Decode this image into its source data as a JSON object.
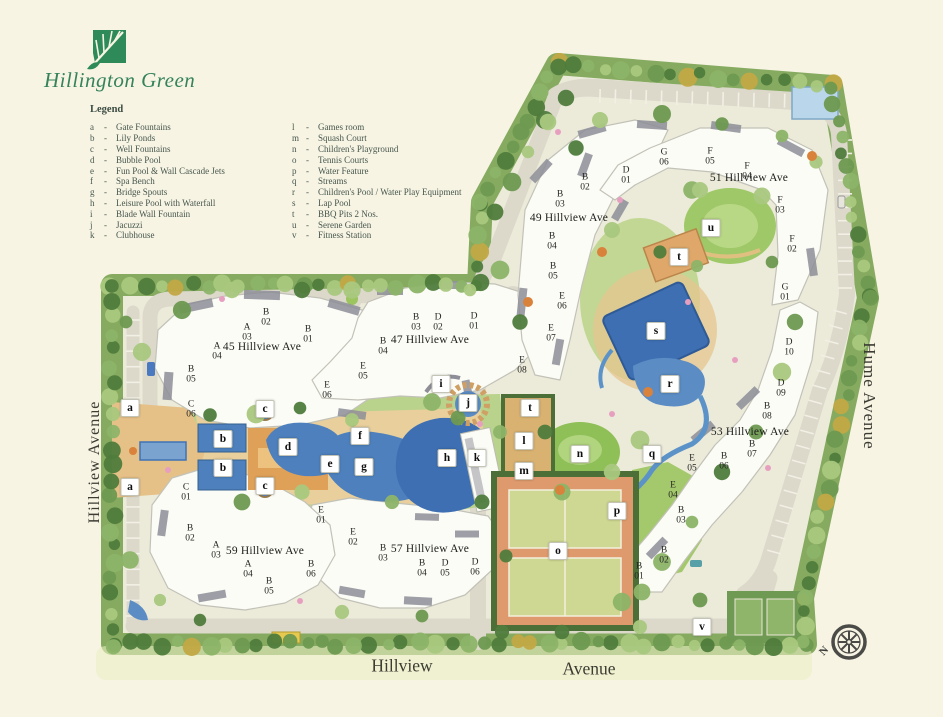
{
  "brand": {
    "name": "Hillington Green",
    "title_color": "#35835b"
  },
  "legend": {
    "heading": "Legend",
    "dash": "-",
    "left": [
      {
        "key": "a",
        "label": "Gate Fountains"
      },
      {
        "key": "b",
        "label": "Lily Ponds"
      },
      {
        "key": "c",
        "label": "Well Fountains"
      },
      {
        "key": "d",
        "label": "Bubble Pool"
      },
      {
        "key": "e",
        "label": "Fun Pool & Wall Cascade Jets"
      },
      {
        "key": "f",
        "label": "Spa Bench"
      },
      {
        "key": "g",
        "label": "Bridge Spouts"
      },
      {
        "key": "h",
        "label": "Leisure Pool with Waterfall"
      },
      {
        "key": "i",
        "label": "Blade Wall Fountain"
      },
      {
        "key": "j",
        "label": "Jacuzzi"
      },
      {
        "key": "k",
        "label": "Clubhouse"
      }
    ],
    "right": [
      {
        "key": "l",
        "label": "Games room"
      },
      {
        "key": "m",
        "label": "Squash Court"
      },
      {
        "key": "n",
        "label": "Children's Playground"
      },
      {
        "key": "o",
        "label": "Tennis Courts"
      },
      {
        "key": "p",
        "label": "Water Feature"
      },
      {
        "key": "q",
        "label": "Streams"
      },
      {
        "key": "r",
        "label": "Children's Pool / Water Play Equipment"
      },
      {
        "key": "s",
        "label": "Lap Pool"
      },
      {
        "key": "t",
        "label": "BBQ Pits 2 Nos."
      },
      {
        "key": "u",
        "label": "Serene Garden"
      },
      {
        "key": "v",
        "label": "Fitness Station"
      }
    ]
  },
  "streets": {
    "left": "Hillview Avenue",
    "right": "Hume Avenue",
    "bottom_left": "Hillview",
    "bottom_right": "Avenue"
  },
  "compass": {
    "label": "N"
  },
  "map": {
    "addresses": [
      {
        "text": "45 Hillview Ave",
        "x": 262,
        "y": 347
      },
      {
        "text": "47 Hillview Ave",
        "x": 430,
        "y": 340
      },
      {
        "text": "49 Hillview Ave",
        "x": 569,
        "y": 218
      },
      {
        "text": "51 Hillview Ave",
        "x": 749,
        "y": 178
      },
      {
        "text": "53 Hillview Ave",
        "x": 750,
        "y": 432
      },
      {
        "text": "57 Hillview Ave",
        "x": 430,
        "y": 549
      },
      {
        "text": "59 Hillview Ave",
        "x": 265,
        "y": 551
      }
    ],
    "blocks": [
      {
        "addr": "45",
        "block": "B",
        "unit": "02",
        "x": 266,
        "y": 318
      },
      {
        "addr": "45",
        "block": "A",
        "unit": "03",
        "x": 247,
        "y": 333
      },
      {
        "addr": "45",
        "block": "A",
        "unit": "04",
        "x": 217,
        "y": 352
      },
      {
        "addr": "45",
        "block": "B",
        "unit": "01",
        "x": 308,
        "y": 335
      },
      {
        "addr": "45",
        "block": "B",
        "unit": "05",
        "x": 191,
        "y": 375
      },
      {
        "addr": "45",
        "block": "C",
        "unit": "06",
        "x": 191,
        "y": 410
      },
      {
        "addr": "47",
        "block": "B",
        "unit": "04",
        "x": 383,
        "y": 347
      },
      {
        "addr": "47",
        "block": "B",
        "unit": "03",
        "x": 416,
        "y": 323
      },
      {
        "addr": "47",
        "block": "D",
        "unit": "02",
        "x": 438,
        "y": 323
      },
      {
        "addr": "47",
        "block": "D",
        "unit": "01",
        "x": 474,
        "y": 322
      },
      {
        "addr": "47",
        "block": "E",
        "unit": "05",
        "x": 363,
        "y": 372
      },
      {
        "addr": "47",
        "block": "E",
        "unit": "06",
        "x": 327,
        "y": 391
      },
      {
        "addr": "49",
        "block": "B",
        "unit": "02",
        "x": 585,
        "y": 183
      },
      {
        "addr": "49",
        "block": "B",
        "unit": "03",
        "x": 560,
        "y": 200
      },
      {
        "addr": "49",
        "block": "B",
        "unit": "04",
        "x": 552,
        "y": 242
      },
      {
        "addr": "49",
        "block": "B",
        "unit": "05",
        "x": 553,
        "y": 272
      },
      {
        "addr": "49",
        "block": "E",
        "unit": "06",
        "x": 562,
        "y": 302
      },
      {
        "addr": "49",
        "block": "E",
        "unit": "07",
        "x": 551,
        "y": 334
      },
      {
        "addr": "49",
        "block": "E",
        "unit": "08",
        "x": 522,
        "y": 366
      },
      {
        "addr": "49",
        "block": "G",
        "unit": "06",
        "x": 664,
        "y": 158
      },
      {
        "addr": "49",
        "block": "D",
        "unit": "01",
        "x": 626,
        "y": 176
      },
      {
        "addr": "51",
        "block": "F",
        "unit": "05",
        "x": 710,
        "y": 157
      },
      {
        "addr": "51",
        "block": "F",
        "unit": "04",
        "x": 747,
        "y": 172
      },
      {
        "addr": "51",
        "block": "F",
        "unit": "03",
        "x": 780,
        "y": 206
      },
      {
        "addr": "51",
        "block": "F",
        "unit": "02",
        "x": 792,
        "y": 245
      },
      {
        "addr": "51",
        "block": "G",
        "unit": "01",
        "x": 785,
        "y": 293
      },
      {
        "addr": "53",
        "block": "D",
        "unit": "10",
        "x": 789,
        "y": 348
      },
      {
        "addr": "53",
        "block": "D",
        "unit": "09",
        "x": 781,
        "y": 389
      },
      {
        "addr": "53",
        "block": "B",
        "unit": "08",
        "x": 767,
        "y": 412
      },
      {
        "addr": "53",
        "block": "B",
        "unit": "07",
        "x": 752,
        "y": 450
      },
      {
        "addr": "53",
        "block": "B",
        "unit": "06",
        "x": 724,
        "y": 462
      },
      {
        "addr": "53",
        "block": "E",
        "unit": "05",
        "x": 692,
        "y": 464
      },
      {
        "addr": "53",
        "block": "E",
        "unit": "04",
        "x": 673,
        "y": 491
      },
      {
        "addr": "53",
        "block": "B",
        "unit": "03",
        "x": 681,
        "y": 516
      },
      {
        "addr": "53",
        "block": "B",
        "unit": "02",
        "x": 664,
        "y": 556
      },
      {
        "addr": "53",
        "block": "B",
        "unit": "01",
        "x": 639,
        "y": 572
      },
      {
        "addr": "57",
        "block": "E",
        "unit": "01",
        "x": 321,
        "y": 516
      },
      {
        "addr": "57",
        "block": "E",
        "unit": "02",
        "x": 353,
        "y": 538
      },
      {
        "addr": "57",
        "block": "B",
        "unit": "03",
        "x": 383,
        "y": 554
      },
      {
        "addr": "57",
        "block": "B",
        "unit": "04",
        "x": 422,
        "y": 569
      },
      {
        "addr": "57",
        "block": "D",
        "unit": "05",
        "x": 445,
        "y": 569
      },
      {
        "addr": "57",
        "block": "D",
        "unit": "06",
        "x": 475,
        "y": 568
      },
      {
        "addr": "59",
        "block": "C",
        "unit": "01",
        "x": 186,
        "y": 493
      },
      {
        "addr": "59",
        "block": "B",
        "unit": "02",
        "x": 190,
        "y": 534
      },
      {
        "addr": "59",
        "block": "A",
        "unit": "03",
        "x": 216,
        "y": 551
      },
      {
        "addr": "59",
        "block": "A",
        "unit": "04",
        "x": 248,
        "y": 570
      },
      {
        "addr": "59",
        "block": "B",
        "unit": "05",
        "x": 269,
        "y": 587
      },
      {
        "addr": "59",
        "block": "B",
        "unit": "06",
        "x": 311,
        "y": 570
      }
    ],
    "markers": [
      {
        "key": "a",
        "x": 130,
        "y": 408
      },
      {
        "key": "a",
        "x": 130,
        "y": 487
      },
      {
        "key": "b",
        "x": 223,
        "y": 439
      },
      {
        "key": "b",
        "x": 223,
        "y": 468
      },
      {
        "key": "c",
        "x": 265,
        "y": 409
      },
      {
        "key": "c",
        "x": 265,
        "y": 486
      },
      {
        "key": "d",
        "x": 288,
        "y": 447
      },
      {
        "key": "e",
        "x": 330,
        "y": 464
      },
      {
        "key": "f",
        "x": 360,
        "y": 436
      },
      {
        "key": "g",
        "x": 364,
        "y": 467
      },
      {
        "key": "h",
        "x": 447,
        "y": 458
      },
      {
        "key": "i",
        "x": 441,
        "y": 384
      },
      {
        "key": "j",
        "x": 468,
        "y": 403
      },
      {
        "key": "k",
        "x": 477,
        "y": 458
      },
      {
        "key": "l",
        "x": 524,
        "y": 441
      },
      {
        "key": "m",
        "x": 524,
        "y": 471
      },
      {
        "key": "n",
        "x": 580,
        "y": 454
      },
      {
        "key": "o",
        "x": 558,
        "y": 551
      },
      {
        "key": "p",
        "x": 617,
        "y": 511
      },
      {
        "key": "q",
        "x": 652,
        "y": 454
      },
      {
        "key": "r",
        "x": 670,
        "y": 384
      },
      {
        "key": "s",
        "x": 656,
        "y": 331
      },
      {
        "key": "t",
        "x": 679,
        "y": 257
      },
      {
        "key": "t",
        "x": 530,
        "y": 408
      },
      {
        "key": "u",
        "x": 711,
        "y": 228
      },
      {
        "key": "v",
        "x": 702,
        "y": 627
      }
    ]
  },
  "colors": {
    "paper": "#f7f4e4",
    "site_base": "#ecebda",
    "road": "#dcd9cb",
    "tree_greens": [
      "#6d9950",
      "#4f7c3c",
      "#8cb468",
      "#a9c87e"
    ],
    "water": "#4d80bd",
    "water_dark": "#3e6fb2",
    "lawn": "#9cc45f",
    "deck_tan": "#e9cf9b",
    "plaza_orange": "#dfa158",
    "tennis_surround": "#de9a6c",
    "tennis_court": "#cfd892",
    "roof_gray": "#8d8e98",
    "brand_green": "#35835b"
  }
}
